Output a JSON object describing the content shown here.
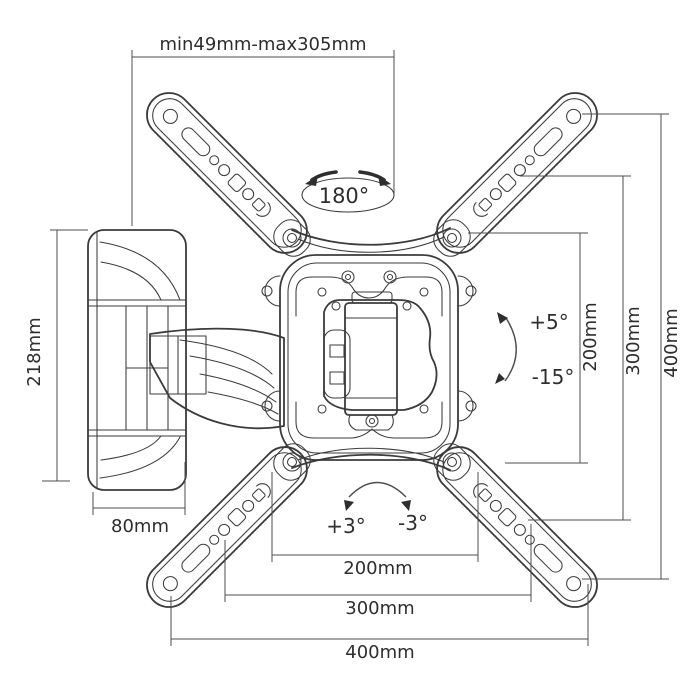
{
  "diagram": {
    "type": "technical-drawing",
    "subject": "full-motion-tv-wall-mount-dimensions",
    "colors": {
      "line": "#3b3b3b",
      "dimension": "#4d4d4d",
      "text": "#2e2e2e",
      "background": "#ffffff"
    },
    "annotations": {
      "extension_range": "min49mm-max305mm",
      "swivel_angle": "180°",
      "bracket_height": "218mm",
      "wall_plate_depth": "80mm",
      "tilt_up": "+5°",
      "tilt_down": "-15°",
      "rotate_plus": "+3°",
      "rotate_minus": "-3°",
      "vesa_vertical": [
        "200mm",
        "300mm",
        "400mm"
      ],
      "vesa_horizontal": [
        "200mm",
        "300mm",
        "400mm"
      ]
    }
  }
}
